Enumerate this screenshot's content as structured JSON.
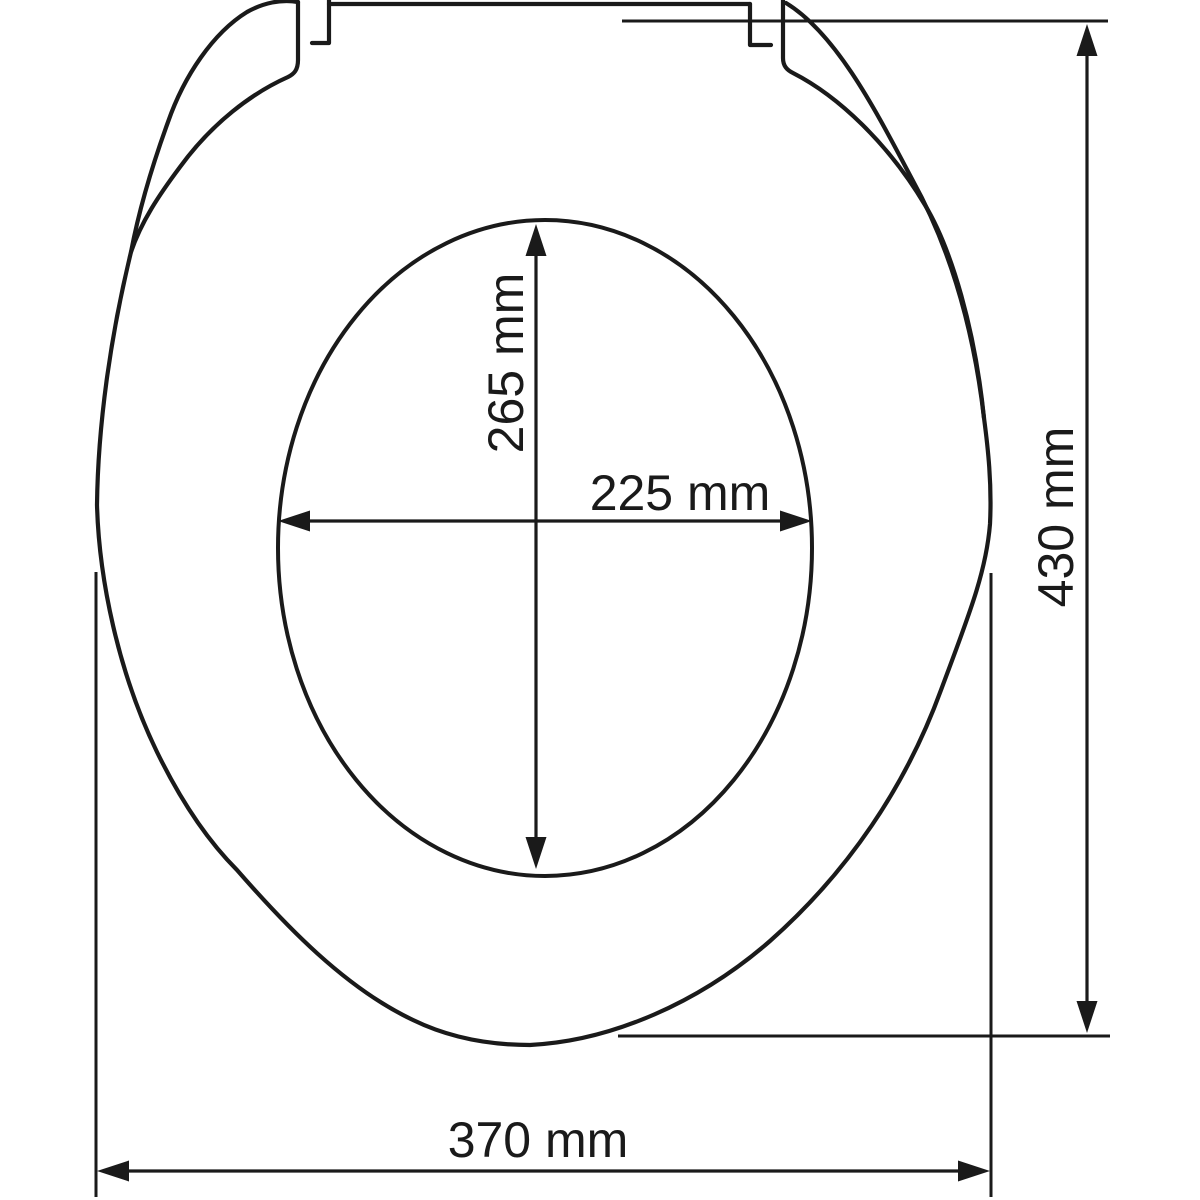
{
  "diagram": {
    "subject": "toilet-seat-top-view-technical-drawing",
    "background_color": "#ffffff",
    "line_color": "#1a1a1a",
    "unit": "mm",
    "dimensions": {
      "inner_height": {
        "label": "265 mm",
        "value": 265,
        "orientation": "vertical",
        "measures": "inner opening height"
      },
      "inner_width": {
        "label": "225 mm",
        "value": 225,
        "orientation": "horizontal",
        "measures": "inner opening width"
      },
      "outer_height": {
        "label": "430 mm",
        "value": 430,
        "orientation": "vertical",
        "measures": "overall seat depth"
      },
      "outer_width": {
        "label": "370 mm",
        "value": 370,
        "orientation": "horizontal",
        "measures": "overall seat width"
      }
    }
  }
}
